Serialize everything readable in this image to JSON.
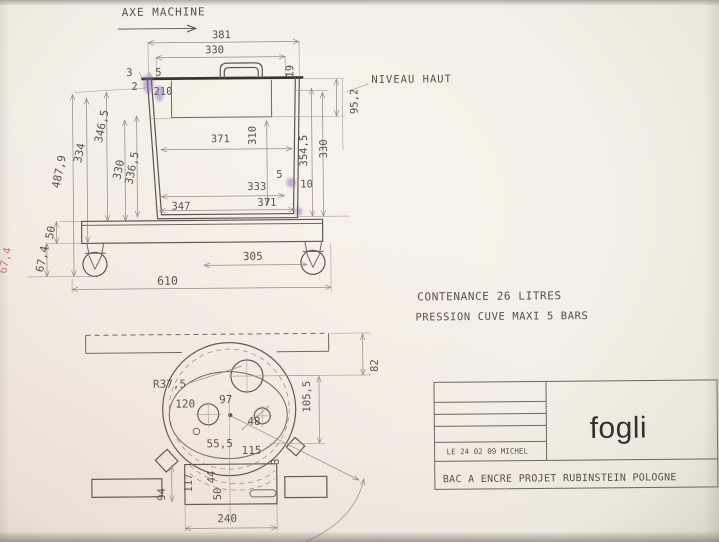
{
  "front_view": {
    "axis_label": "AXE MACHINE",
    "level_label": "NIVEAU HAUT",
    "dims": {
      "overall_width": "381",
      "inner_width": "330",
      "lip_a": "3",
      "lip_b": "5",
      "lid_edge": "19",
      "wall_thickness": "2",
      "window_width": "210",
      "level_depth": "95,2",
      "mid_width": "371",
      "inner_depth": "310",
      "right_depth_a": "354,5",
      "right_depth_b": "330",
      "bottom_inner": "333",
      "bottom_gap": "5",
      "bottom_lip": "10",
      "bottom_width_inner": "347",
      "bottom_width_outer": "371",
      "height_total": "487,9",
      "height_a": "334",
      "height_b": "346,5",
      "height_c": "330",
      "height_d": "336,5",
      "base_height": "50",
      "caster_height": "67,4",
      "caster_height_note": "67,4",
      "wheel_spacing": "305",
      "base_length": "610"
    }
  },
  "notes": {
    "line1": "CONTENANCE 26 LITRES",
    "line2": "PRESSION CUVE MAXI 5 BARS"
  },
  "top_view": {
    "dims": {
      "bar_offset": "82",
      "corner_radius": "R37,5",
      "hole_a": "120",
      "hole_b": "97",
      "hole_c": "48",
      "offset_a": "55,5",
      "offset_b": "115",
      "offset_c": "105,5",
      "foot_offset": "3",
      "bar_width": "94",
      "box_a": "117",
      "box_b": "44",
      "box_c": "50",
      "box_width": "240"
    }
  },
  "title_block": {
    "logo": "fogli",
    "date_author": "LE 24 02 09 MICHEL",
    "title": "BAC A ENCRE PROJET RUBINSTEIN POLOGNE"
  },
  "colors": {
    "paper": "#f4f0e7",
    "line": "#5a564e",
    "dim_line": "#938e84",
    "ink_mark": "#7e63b8",
    "pink_note": "#cf7580"
  }
}
